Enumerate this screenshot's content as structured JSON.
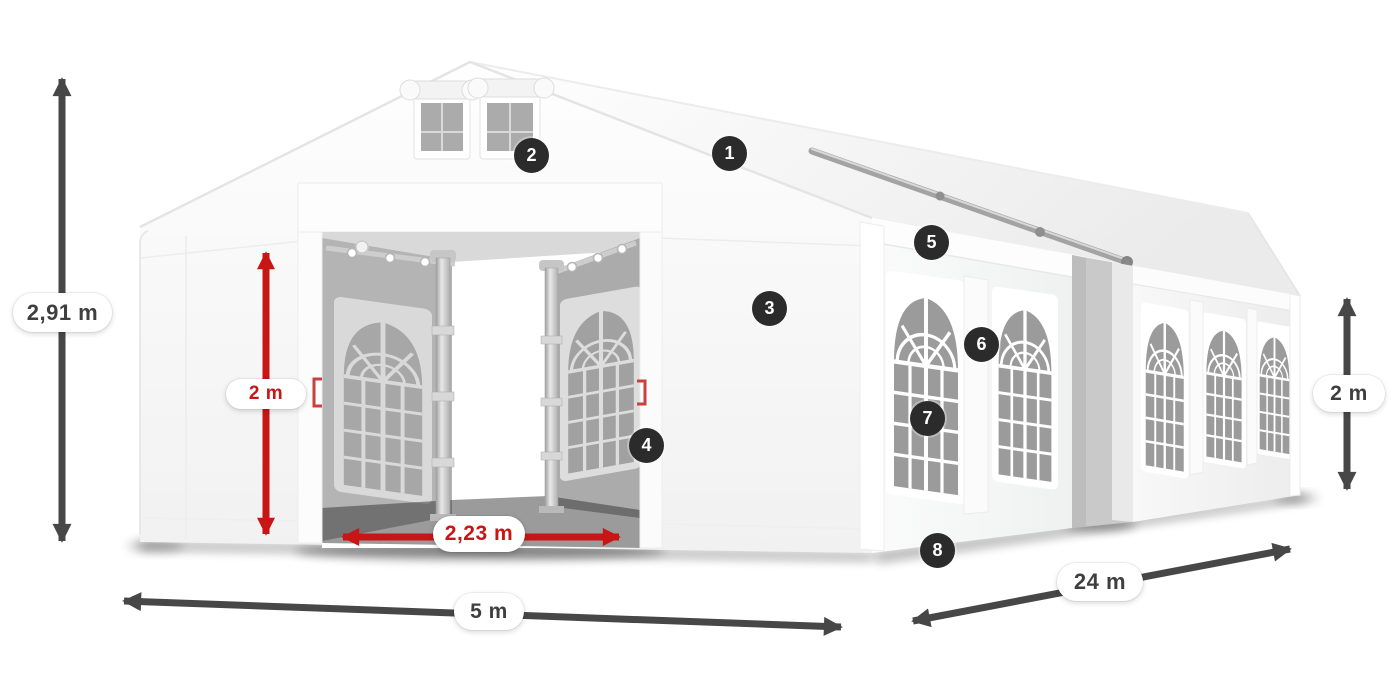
{
  "diagram": {
    "description": "White marquee party tent in three-quarter view with open front entrance, gable vents, arched side windows, dimension arrows and numbered part callouts",
    "dimensions": [
      {
        "id": "total-height",
        "label": "2,91 m",
        "style": "dark",
        "orientation": "vertical",
        "position": "far-left"
      },
      {
        "id": "entrance-height",
        "label": "2 m",
        "style": "red",
        "orientation": "vertical",
        "position": "front-entrance"
      },
      {
        "id": "entrance-width",
        "label": "2,23 m",
        "style": "red",
        "orientation": "horizontal",
        "position": "door-opening"
      },
      {
        "id": "front-width",
        "label": "5 m",
        "style": "dark",
        "orientation": "horizontal",
        "position": "bottom-front"
      },
      {
        "id": "side-length",
        "label": "24 m",
        "style": "dark",
        "orientation": "diagonal",
        "position": "bottom-right"
      },
      {
        "id": "side-wall-height",
        "label": "2 m",
        "style": "dark",
        "orientation": "vertical",
        "position": "far-right"
      }
    ],
    "callouts": [
      {
        "number": "1",
        "placement": "roof-slope"
      },
      {
        "number": "2",
        "placement": "gable-vent"
      },
      {
        "number": "3",
        "placement": "front-wall-panel"
      },
      {
        "number": "4",
        "placement": "door-edge"
      },
      {
        "number": "5",
        "placement": "side-eave"
      },
      {
        "number": "6",
        "placement": "window-strap"
      },
      {
        "number": "7",
        "placement": "side-window"
      },
      {
        "number": "8",
        "placement": "wall-base"
      }
    ]
  },
  "colors": {
    "dimension_arrow_dark": "#474747",
    "dimension_arrow_red": "#c81515",
    "label_text_dark": "#3f3f3f",
    "label_text_red": "#c81515",
    "badge_background": "#2b2b2b",
    "badge_text": "#ffffff",
    "tent_white": "#ffffff",
    "window_glass": "#9b9b9b"
  }
}
